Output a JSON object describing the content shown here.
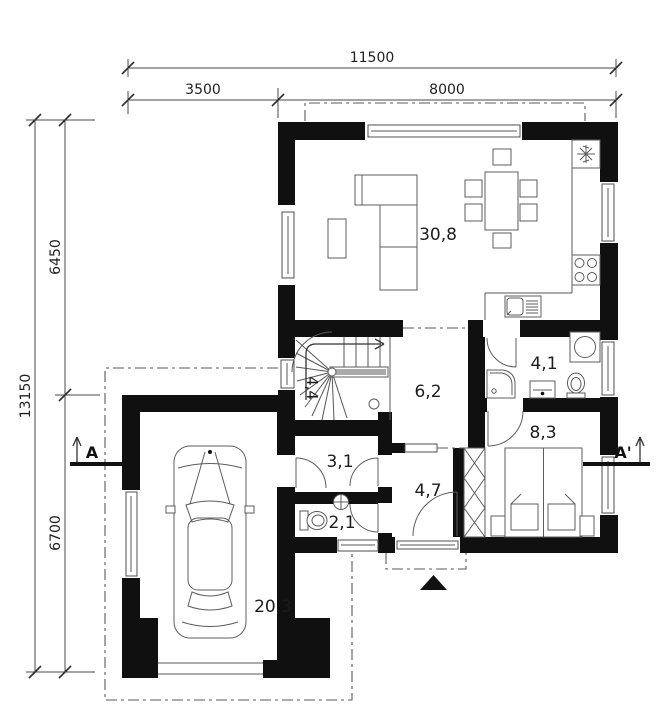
{
  "plan": {
    "type": "floor-plan",
    "dimensions": {
      "top": {
        "total": "11500",
        "segments": [
          "3500",
          "8000"
        ]
      },
      "left": {
        "total": "13150",
        "segments": [
          "6450",
          "6700"
        ]
      }
    },
    "section_markers": {
      "left": "A",
      "right": "A'"
    },
    "rooms": [
      {
        "name": "living-room-kitchen",
        "area_label": "30,8"
      },
      {
        "name": "staircase",
        "area_label": "4,4"
      },
      {
        "name": "hall",
        "area_label": "6,2"
      },
      {
        "name": "bathroom",
        "area_label": "4,1"
      },
      {
        "name": "bedroom",
        "area_label": "8,3"
      },
      {
        "name": "utility-room",
        "area_label": "3,1"
      },
      {
        "name": "wc",
        "area_label": "2,1"
      },
      {
        "name": "vestibule",
        "area_label": "4,7"
      },
      {
        "name": "garage",
        "area_label": "20,3"
      }
    ],
    "colors": {
      "wall": "#101010",
      "line": "#575757",
      "background": "#ffffff",
      "text": "#1c1c1c"
    }
  }
}
